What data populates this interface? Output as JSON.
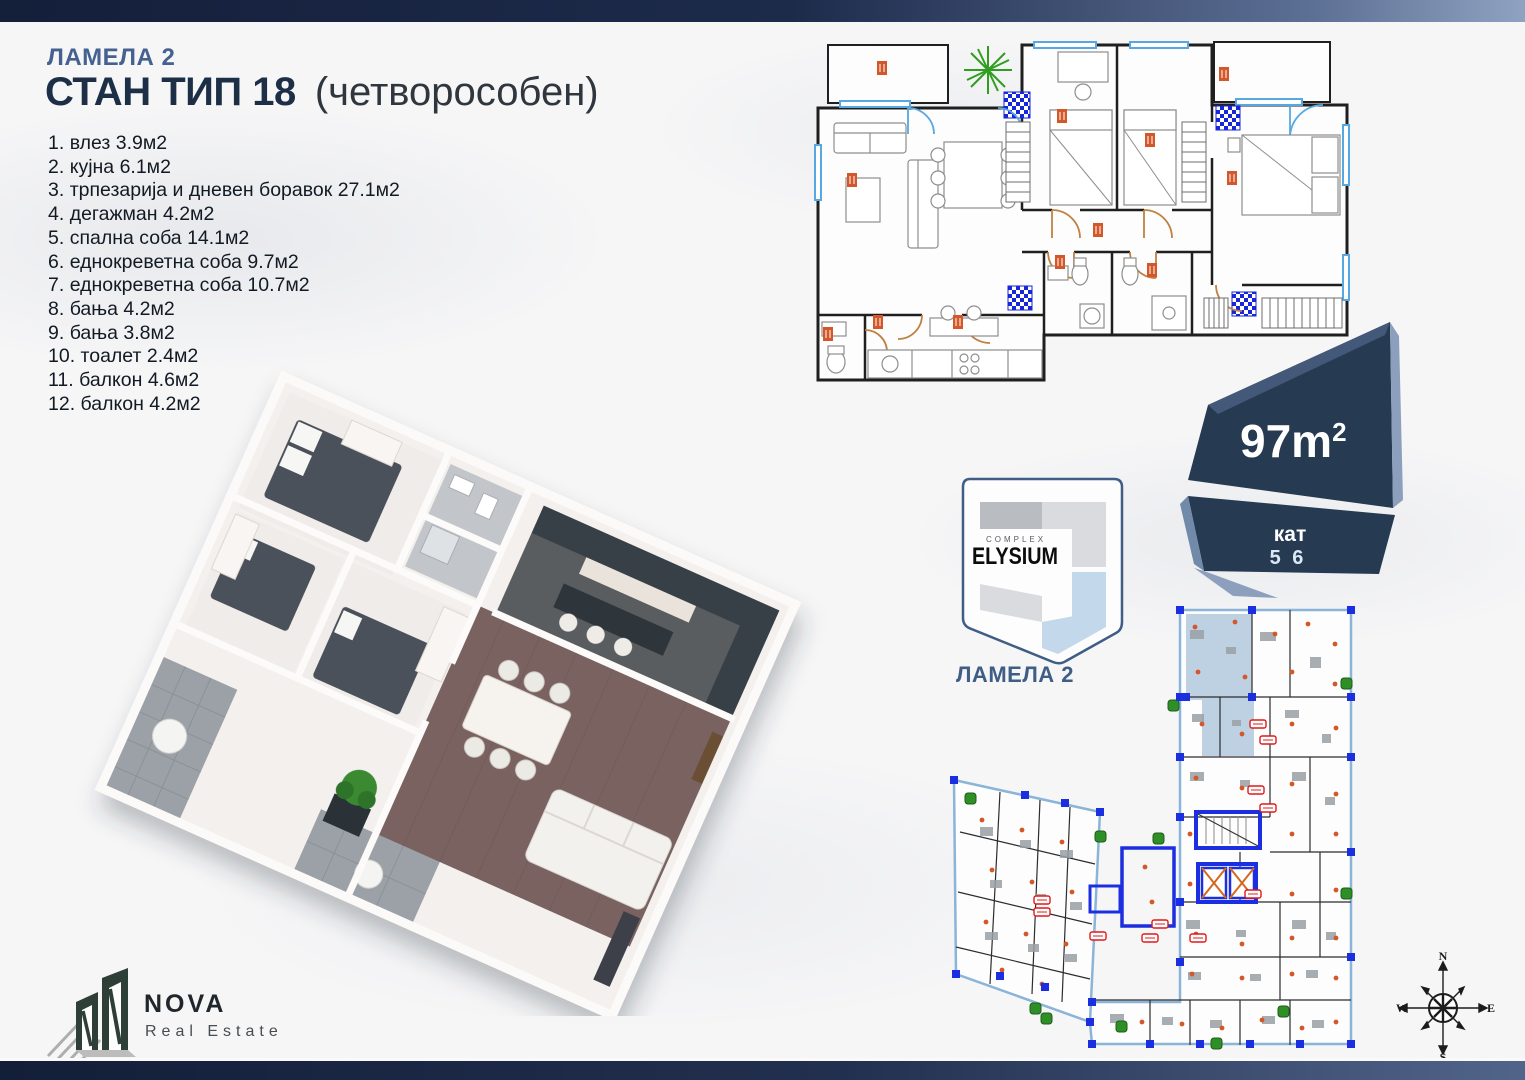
{
  "header": {
    "lamela": "ЛАМЕЛА 2",
    "title": "СТАН ТИП 18",
    "title_suffix": "(четворособен)"
  },
  "rooms": [
    {
      "num": "1.",
      "name": "влез",
      "area": "3.9м2"
    },
    {
      "num": "2.",
      "name": "кујна",
      "area": "6.1м2"
    },
    {
      "num": "3.",
      "name": "трпезарија и дневен боравок",
      "area": "27.1м2"
    },
    {
      "num": "4.",
      "name": "дегажман",
      "area": "4.2м2"
    },
    {
      "num": "5.",
      "name": "спална соба",
      "area": "14.1м2"
    },
    {
      "num": "6.",
      "name": "еднокреветна соба",
      "area": "9.7м2"
    },
    {
      "num": "7.",
      "name": "еднокреветна соба",
      "area": "10.7м2"
    },
    {
      "num": "8.",
      "name": "бања",
      "area": "4.2м2"
    },
    {
      "num": "9.",
      "name": "бања",
      "area": "3.8м2"
    },
    {
      "num": "10.",
      "name": "тоалет",
      "area": "2.4м2"
    },
    {
      "num": "11.",
      "name": "балкон",
      "area": "4.6м2"
    },
    {
      "num": "12.",
      "name": "балкон",
      "area": "4.2м2"
    }
  ],
  "badge": {
    "area_value": "97m",
    "area_sup": "2",
    "floor_label": "кат",
    "floor_numbers": "5 6"
  },
  "elysium": {
    "complex": "COMPLEX",
    "name": "ELYSIUM",
    "lamela": "ЛАМЕЛА 2"
  },
  "nova": {
    "name": "NOVA",
    "subtitle": "Real Estate"
  },
  "compass": {
    "north": "N",
    "south": "S",
    "east": "E",
    "west": "W"
  },
  "colors": {
    "navy_dark": "#1c2f47",
    "slate_heading": "#44618f",
    "badge_face": "#263a52",
    "badge_bevel": "#8c9fbc",
    "plan_wall": "#1f1f1f",
    "plan_window_blue": "#57a7e2",
    "plan_door_tan": "#c08040",
    "plan_label_orange": "#d4572a",
    "plan_shaft_blue": "#1626d8",
    "building_core_blue": "#1c2fe0",
    "building_highlight": "#b7cce0",
    "plant_green": "#2f9e1f"
  }
}
